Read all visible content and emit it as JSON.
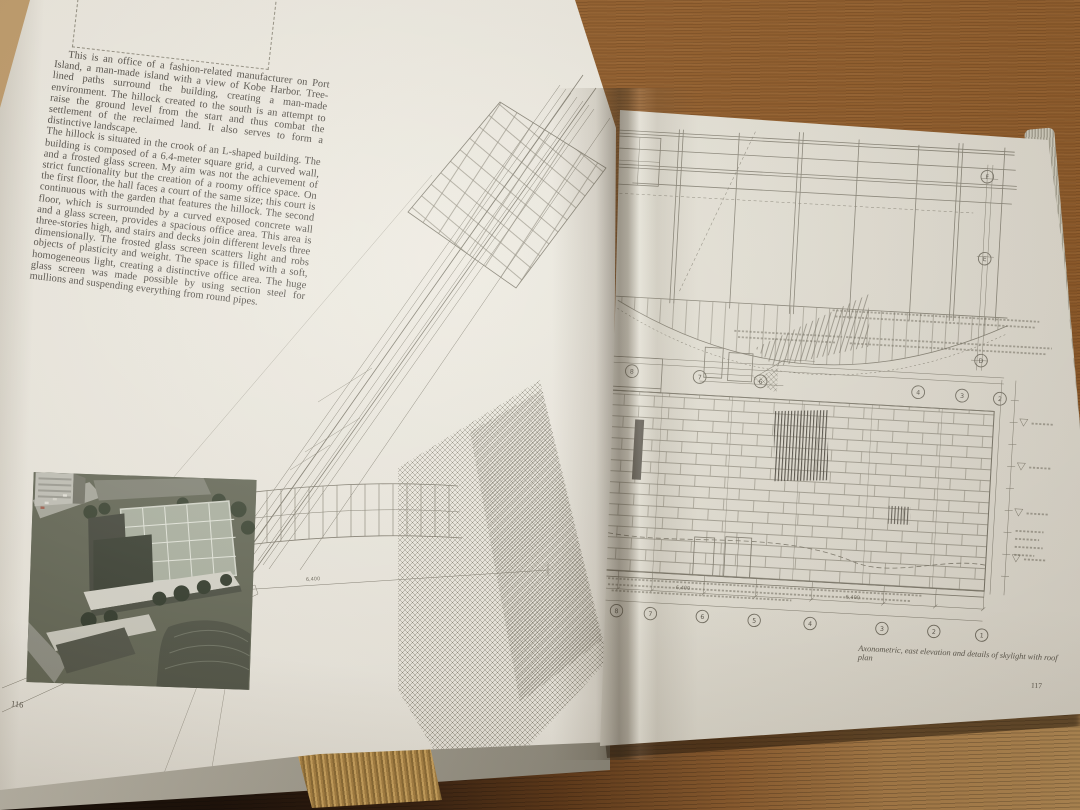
{
  "left_page": {
    "paragraph1": "This is an office of a fashion-related manufacturer on Port Island, a man-made island with a view of Kobe Harbor. Tree-lined paths surround the building, creating a man-made environment. The hillock created to the south is an attempt to raise the ground level from the start and thus combat the settlement of the reclaimed land. It also serves to form a distinctive landscape.",
    "paragraph2": "The hillock is situated in the crook of an L-shaped building. The building is composed of a 6.4-meter square grid, a curved wall, and a frosted glass screen. My aim was not the achievement of strict functionality but the creation of a roomy office space. On the first floor, the hall faces a court of the same size; this court is continuous with the garden that features the hillock. The second floor, which is surrounded by a curved exposed concrete wall and a glass screen, provides a spacious office area. This area is three-stories high, and stairs and decks join different levels three dimensionally. The frosted glass screen scatters light and robs objects of plasticity and weight. The space is filled with a soft, homogeneous light, creating a distinctive office area. The huge glass screen was made possible by using section steel for mullions and suspending everything from round pipes.",
    "page_number": "116"
  },
  "right_page": {
    "caption": "Axonometric, east elevation and details of skylight with roof plan",
    "page_number": "117"
  },
  "drawings": {
    "roof_plan": {
      "col_refs": [
        "9",
        "8",
        "7",
        "6",
        "4",
        "3",
        "2"
      ],
      "row_refs": [
        "F",
        "E",
        "D"
      ]
    },
    "elevation": {
      "col_refs": [
        "10",
        "9",
        "8",
        "7",
        "6",
        "5",
        "4",
        "3",
        "2",
        "1"
      ],
      "dims": [
        "6,400",
        "6,400"
      ]
    },
    "axonometric": {
      "ref": "M",
      "dim": "6,400"
    }
  },
  "colors": {
    "paper": "#ebe8df",
    "paper_shadow": "#cecbc0",
    "drawing_ink": "#7d796c",
    "text_ink": "#45413b",
    "table_wood": "#8d5827",
    "table_wood_light": "#c3a070",
    "gilt_edge": "#c7a05c"
  }
}
